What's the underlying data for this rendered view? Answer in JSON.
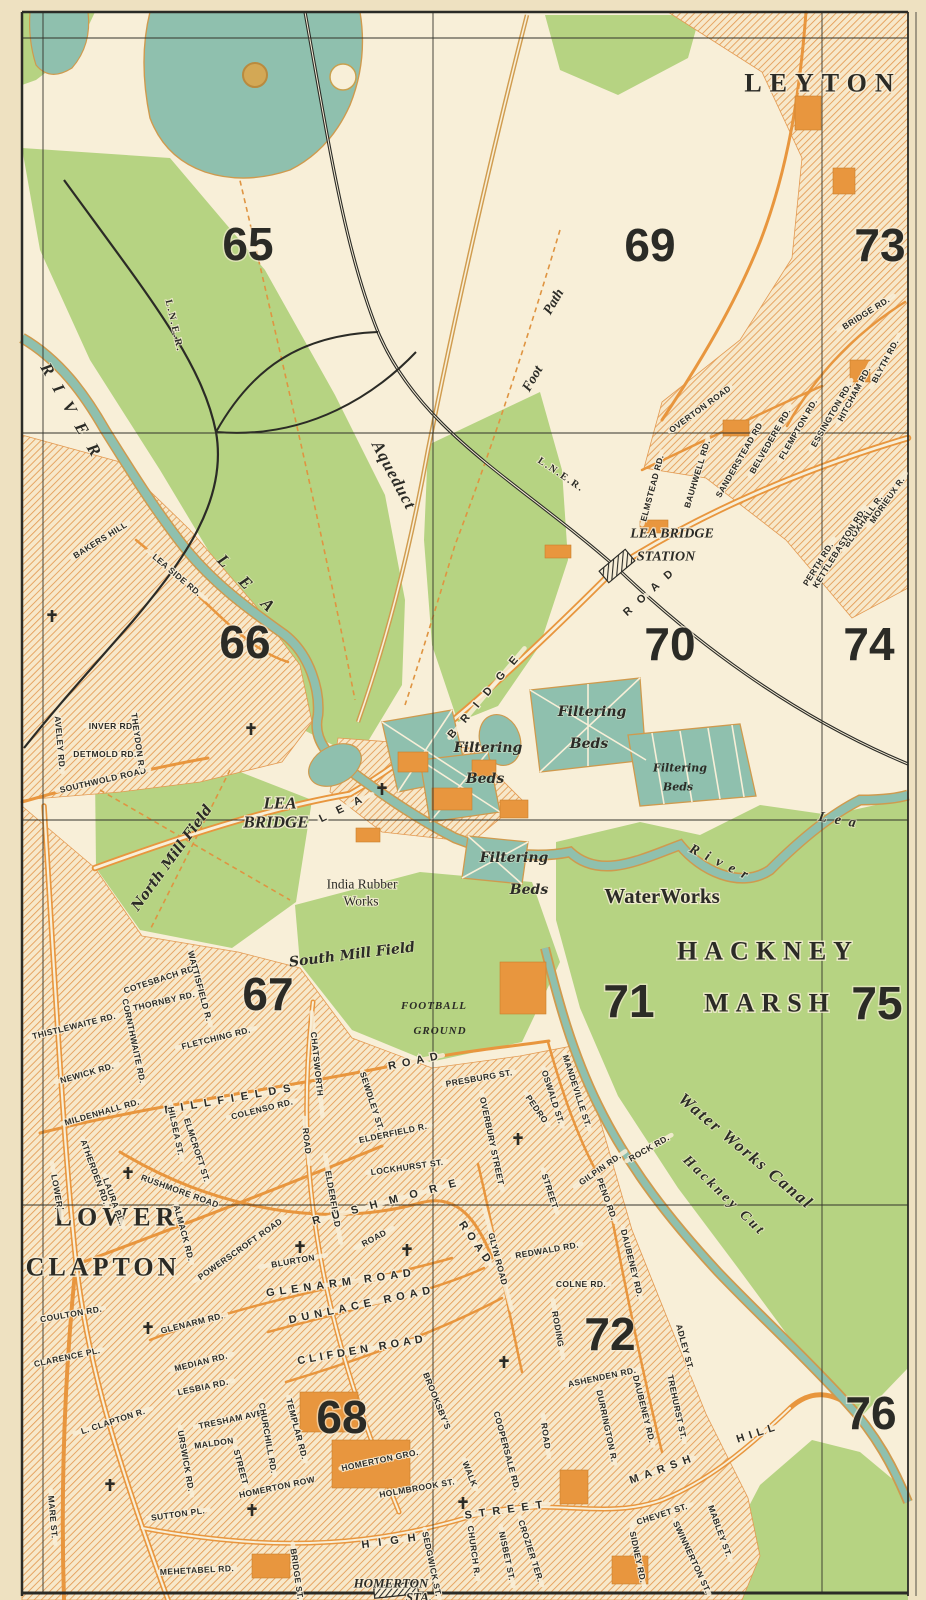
{
  "map": {
    "colors": {
      "paper": "#eee1c1",
      "map_bg": "#f8efd8",
      "green": "#b6d382",
      "water_teal": "#8fc0ae",
      "road_orange": "#e8963e",
      "ink": "#2b2b26"
    },
    "towns": [
      {
        "t": "LEYTON",
        "x": 823,
        "y": 83,
        "r": 0,
        "ls": 8,
        "fs": 26
      },
      {
        "t": "HACKNEY",
        "x": 768,
        "y": 951,
        "r": 0,
        "ls": 7,
        "fs": 27
      },
      {
        "t": "MARSH",
        "x": 770,
        "y": 1003,
        "r": 0,
        "ls": 7,
        "fs": 27
      },
      {
        "t": "LOWER",
        "x": 117,
        "y": 1217,
        "r": 0,
        "ls": 5,
        "fs": 25
      },
      {
        "t": "CLAPTON",
        "x": 103,
        "y": 1267,
        "r": 0,
        "ls": 4,
        "fs": 25
      }
    ],
    "grid_numbers": [
      {
        "t": "65",
        "x": 248,
        "y": 244
      },
      {
        "t": "69",
        "x": 650,
        "y": 245
      },
      {
        "t": "73",
        "x": 880,
        "y": 245
      },
      {
        "t": "66",
        "x": 245,
        "y": 642
      },
      {
        "t": "70",
        "x": 670,
        "y": 644
      },
      {
        "t": "74",
        "x": 869,
        "y": 644
      },
      {
        "t": "67",
        "x": 268,
        "y": 994
      },
      {
        "t": "71",
        "x": 629,
        "y": 1001
      },
      {
        "t": "75",
        "x": 877,
        "y": 1003
      },
      {
        "t": "68",
        "x": 342,
        "y": 1417
      },
      {
        "t": "72",
        "x": 610,
        "y": 1334
      },
      {
        "t": "76",
        "x": 871,
        "y": 1413
      }
    ],
    "places": [
      {
        "t": "LEA BRIDGE",
        "x": 672,
        "y": 534,
        "r": 0,
        "c": "place"
      },
      {
        "t": "STATION",
        "x": 666,
        "y": 557,
        "r": 0,
        "c": "place"
      },
      {
        "t": "LEA",
        "x": 280,
        "y": 803,
        "r": 0,
        "c": "place-lg"
      },
      {
        "t": "BRIDGE",
        "x": 276,
        "y": 822,
        "r": 0,
        "c": "place-lg"
      },
      {
        "t": "India Rubber",
        "x": 362,
        "y": 884,
        "r": 0,
        "c": "place-rm"
      },
      {
        "t": "Works",
        "x": 361,
        "y": 901,
        "r": 0,
        "c": "place-rm"
      },
      {
        "t": "WaterWorks",
        "x": 662,
        "y": 896,
        "r": 0,
        "c": "place-xl"
      },
      {
        "t": "HOMERTON",
        "x": 391,
        "y": 1583,
        "r": 0,
        "c": "place-it"
      },
      {
        "t": "STA.",
        "x": 419,
        "y": 1597,
        "r": 0,
        "c": "place-it"
      }
    ],
    "water_features": [
      {
        "t": "RIVER",
        "x": 74,
        "y": 415,
        "r": 60,
        "ls": 13,
        "c": "water-lg"
      },
      {
        "t": "LEA",
        "x": 253,
        "y": 590,
        "r": 45,
        "ls": 20,
        "c": "water-lg"
      },
      {
        "t": "River",
        "x": 722,
        "y": 864,
        "r": 26,
        "ls": 8
      },
      {
        "t": "Lea",
        "x": 841,
        "y": 821,
        "r": 10,
        "ls": 8
      },
      {
        "t": "Water Works Canal",
        "x": 746,
        "y": 1151,
        "r": 40,
        "ls": 2,
        "c": "water-lg"
      },
      {
        "t": "Hackney Cut",
        "x": 724,
        "y": 1196,
        "r": 44,
        "ls": 3
      },
      {
        "t": "Aqueduct",
        "x": 394,
        "y": 475,
        "r": 62,
        "ls": 1,
        "c": "water-lg"
      },
      {
        "t": "Foot",
        "x": 533,
        "y": 379,
        "r": -60
      },
      {
        "t": "Path",
        "x": 554,
        "y": 302,
        "r": -60
      }
    ],
    "railways": [
      {
        "t": "L.N.E.R.",
        "x": 174,
        "y": 326,
        "r": 77
      },
      {
        "t": "L.N.E.R.",
        "x": 561,
        "y": 475,
        "r": 34,
        "ls": 3
      }
    ],
    "fields": [
      {
        "t": "North Mill Field",
        "x": 172,
        "y": 858,
        "r": -54
      },
      {
        "t": "South Mill Field",
        "x": 352,
        "y": 955,
        "r": -7
      },
      {
        "t": "FOOTBALL",
        "x": 434,
        "y": 1006,
        "r": 0,
        "c": "field-caps"
      },
      {
        "t": "GROUND",
        "x": 440,
        "y": 1031,
        "r": 0,
        "c": "field-caps"
      },
      {
        "t": "Filtering",
        "x": 592,
        "y": 712,
        "r": 0
      },
      {
        "t": "Beds",
        "x": 589,
        "y": 744,
        "r": 0
      },
      {
        "t": "Filtering",
        "x": 488,
        "y": 748,
        "r": 0
      },
      {
        "t": "Beds",
        "x": 485,
        "y": 779,
        "r": 0
      },
      {
        "t": "Filtering",
        "x": 680,
        "y": 768,
        "r": 0,
        "c": "field-sm"
      },
      {
        "t": "Beds",
        "x": 678,
        "y": 787,
        "r": 0,
        "c": "field-sm"
      },
      {
        "t": "Filtering",
        "x": 514,
        "y": 858,
        "r": 0
      },
      {
        "t": "Beds",
        "x": 529,
        "y": 890,
        "r": 0
      }
    ],
    "streets": [
      {
        "t": "BRIDGE RD.",
        "x": 866,
        "y": 313,
        "r": -32
      },
      {
        "t": "BLYTH RD.",
        "x": 885,
        "y": 361,
        "r": -62
      },
      {
        "t": "HITCHAM RD.",
        "x": 854,
        "y": 394,
        "r": -62
      },
      {
        "t": "ESSINGTON RD.",
        "x": 831,
        "y": 415,
        "r": -60
      },
      {
        "t": "FLEMPTON RD.",
        "x": 798,
        "y": 429,
        "r": -60
      },
      {
        "t": "BELVEDERE RD.",
        "x": 770,
        "y": 441,
        "r": -60
      },
      {
        "t": "SANDERSTEAD RD",
        "x": 739,
        "y": 460,
        "r": -60
      },
      {
        "t": "OVERTON ROAD",
        "x": 700,
        "y": 409,
        "r": -36
      },
      {
        "t": "BAUHWELL RD.",
        "x": 697,
        "y": 474,
        "r": -73
      },
      {
        "t": "ELMSTEAD RD.",
        "x": 652,
        "y": 488,
        "r": -75
      },
      {
        "t": "MORIEUX R.",
        "x": 887,
        "y": 500,
        "r": -55
      },
      {
        "t": "BLOXHALL R.",
        "x": 863,
        "y": 521,
        "r": -55
      },
      {
        "t": "KETTLEBASTON RD.",
        "x": 839,
        "y": 548,
        "r": -58
      },
      {
        "t": "PERTH RD.",
        "x": 818,
        "y": 564,
        "r": -58
      },
      {
        "t": "LEA",
        "x": 346,
        "y": 807,
        "r": -26,
        "ls": 12,
        "fs": 12,
        "c": "street-lg"
      },
      {
        "t": "BRIDGE",
        "x": 487,
        "y": 693,
        "r": -50,
        "ls": 12,
        "fs": 12,
        "c": "street-lg"
      },
      {
        "t": "ROAD",
        "x": 652,
        "y": 590,
        "r": -42,
        "ls": 10,
        "fs": 12,
        "c": "street-lg"
      },
      {
        "t": "SOUTHWOLD ROAD",
        "x": 103,
        "y": 780,
        "r": -13,
        "fs": 9.5
      },
      {
        "t": "INVER RD.",
        "x": 112,
        "y": 726,
        "r": 0,
        "fs": 7.5
      },
      {
        "t": "DETMOLD RD.",
        "x": 105,
        "y": 754,
        "r": 0,
        "fs": 7.5
      },
      {
        "t": "THEYDON R.",
        "x": 138,
        "y": 741,
        "r": 82,
        "fs": 7.5
      },
      {
        "t": "AVELEY RD.",
        "x": 60,
        "y": 743,
        "r": 85,
        "fs": 7.5
      },
      {
        "t": "LEA SIDE RD.",
        "x": 177,
        "y": 575,
        "r": 40
      },
      {
        "t": "BAKERS HILL",
        "x": 100,
        "y": 540,
        "r": -32,
        "fs": 8
      },
      {
        "t": "THISTLEWAITE RD.",
        "x": 74,
        "y": 1026,
        "r": -14,
        "fs": 8
      },
      {
        "t": "NEWICK RD.",
        "x": 87,
        "y": 1073,
        "r": -16
      },
      {
        "t": "MILDENHALL RD.",
        "x": 102,
        "y": 1112,
        "r": -16,
        "fs": 8
      },
      {
        "t": "CORNTHWAITE RD.",
        "x": 134,
        "y": 1041,
        "r": 78,
        "fs": 8
      },
      {
        "t": "THORNBY RD.",
        "x": 164,
        "y": 1001,
        "r": -13,
        "fs": 8
      },
      {
        "t": "COTESBACH RD.",
        "x": 160,
        "y": 979,
        "r": -18,
        "fs": 8
      },
      {
        "t": "WATTISFIELD R.",
        "x": 200,
        "y": 986,
        "r": 75,
        "fs": 8
      },
      {
        "t": "FLETCHING RD.",
        "x": 216,
        "y": 1038,
        "r": -14
      },
      {
        "t": "MILLFIELDS",
        "x": 231,
        "y": 1099,
        "r": -10,
        "ls": 7,
        "fs": 10,
        "c": "street-lg"
      },
      {
        "t": "ROAD",
        "x": 416,
        "y": 1061,
        "r": -12,
        "ls": 6,
        "fs": 10,
        "c": "street-lg"
      },
      {
        "t": "HILSEA ST.",
        "x": 176,
        "y": 1131,
        "r": 78,
        "fs": 7.5
      },
      {
        "t": "ELMCROFT ST.",
        "x": 197,
        "y": 1150,
        "r": 72,
        "fs": 7.5
      },
      {
        "t": "COLENSO RD.",
        "x": 262,
        "y": 1109,
        "r": -14
      },
      {
        "t": "SEWDLEY ST.",
        "x": 372,
        "y": 1101,
        "r": 72,
        "fs": 7.5
      },
      {
        "t": "ELDERFIELD R.",
        "x": 393,
        "y": 1133,
        "r": -12,
        "fs": 8
      },
      {
        "t": "LOCKHURST ST.",
        "x": 407,
        "y": 1167,
        "r": -8
      },
      {
        "t": "CHATSWORTH",
        "x": 317,
        "y": 1064,
        "r": 84,
        "ls": 4,
        "fs": 9
      },
      {
        "t": "ROAD",
        "x": 307,
        "y": 1141,
        "r": 84,
        "ls": 4,
        "fs": 9
      },
      {
        "t": "ELDERFIELD",
        "x": 333,
        "y": 1199,
        "r": 80,
        "ls": 3,
        "fs": 8
      },
      {
        "t": "ATHERDEN RD.",
        "x": 95,
        "y": 1172,
        "r": 70,
        "fs": 8
      },
      {
        "t": "LAURA PL.",
        "x": 114,
        "y": 1201,
        "r": 70,
        "fs": 8
      },
      {
        "t": "LOWER",
        "x": 57,
        "y": 1191,
        "r": 80,
        "ls": 4,
        "fs": 9
      },
      {
        "t": "L. CLAPTON R.",
        "x": 113,
        "y": 1421,
        "r": -18
      },
      {
        "t": "MARE ST.",
        "x": 53,
        "y": 1517,
        "r": 85
      },
      {
        "t": "COULTON RD.",
        "x": 71,
        "y": 1314,
        "r": -10,
        "fs": 8
      },
      {
        "t": "CLARENCE PL.",
        "x": 67,
        "y": 1357,
        "r": -12,
        "fs": 8
      },
      {
        "t": "GLENARM RD.",
        "x": 192,
        "y": 1323,
        "r": -14
      },
      {
        "t": "MEDIAN RD.",
        "x": 201,
        "y": 1362,
        "r": -14
      },
      {
        "t": "LESBIA RD.",
        "x": 203,
        "y": 1387,
        "r": -12,
        "fs": 8
      },
      {
        "t": "TRESHAM AVE.",
        "x": 232,
        "y": 1419,
        "r": -12
      },
      {
        "t": "URSWICK RD.",
        "x": 186,
        "y": 1461,
        "r": 80
      },
      {
        "t": "MALDON",
        "x": 214,
        "y": 1443,
        "r": -8,
        "fs": 8
      },
      {
        "t": "STREET",
        "x": 241,
        "y": 1467,
        "r": 75,
        "fs": 8
      },
      {
        "t": "SUTTON PL.",
        "x": 178,
        "y": 1514,
        "r": -8,
        "fs": 8
      },
      {
        "t": "CHURCHILL RD.",
        "x": 268,
        "y": 1438,
        "r": 80,
        "fs": 8
      },
      {
        "t": "TEMPLAR RD.",
        "x": 297,
        "y": 1429,
        "r": 75,
        "fs": 8
      },
      {
        "t": "HOMERTON ROW",
        "x": 277,
        "y": 1487,
        "r": -12
      },
      {
        "t": "HOMERTON GRO.",
        "x": 380,
        "y": 1460,
        "r": -12
      },
      {
        "t": "HOLMBROOK ST.",
        "x": 417,
        "y": 1488,
        "r": -10,
        "fs": 8
      },
      {
        "t": "HIGH",
        "x": 393,
        "y": 1541,
        "r": -8,
        "ls": 9,
        "fs": 10,
        "c": "street-lg"
      },
      {
        "t": "STREET",
        "x": 507,
        "y": 1510,
        "r": -8,
        "ls": 7,
        "fs": 10,
        "c": "street-lg"
      },
      {
        "t": "MEHETABEL RD.",
        "x": 197,
        "y": 1570,
        "r": -3,
        "fs": 8
      },
      {
        "t": "BRIDGE ST.",
        "x": 297,
        "y": 1574,
        "r": 82,
        "fs": 8
      },
      {
        "t": "SEDGWICK ST.",
        "x": 432,
        "y": 1564,
        "r": 78,
        "fs": 8
      },
      {
        "t": "CHURCH R.",
        "x": 474,
        "y": 1551,
        "r": 82,
        "fs": 8
      },
      {
        "t": "NISBET ST.",
        "x": 507,
        "y": 1556,
        "r": 78,
        "fs": 8
      },
      {
        "t": "CROZIER TER.",
        "x": 531,
        "y": 1551,
        "r": 72,
        "fs": 8
      },
      {
        "t": "COOPERSALE RD.",
        "x": 507,
        "y": 1451,
        "r": 75,
        "fs": 8
      },
      {
        "t": "BROOKSBY'S",
        "x": 437,
        "y": 1401,
        "r": 68,
        "fs": 8
      },
      {
        "t": "WALK",
        "x": 470,
        "y": 1474,
        "r": 68,
        "fs": 8
      },
      {
        "t": "POWERSCROFT ROAD",
        "x": 240,
        "y": 1249,
        "r": -35,
        "ls": 1
      },
      {
        "t": "ALMACK RD.",
        "x": 184,
        "y": 1233,
        "r": 75,
        "fs": 8
      },
      {
        "t": "BLURTON",
        "x": 293,
        "y": 1261,
        "r": -10,
        "ls": 3
      },
      {
        "t": "ROAD",
        "x": 374,
        "y": 1238,
        "r": -28,
        "ls": 3
      },
      {
        "t": "GLENARM ROAD",
        "x": 341,
        "y": 1283,
        "r": -8,
        "ls": 5,
        "fs": 9.5,
        "c": "street-lg"
      },
      {
        "t": "DUNLACE ROAD",
        "x": 362,
        "y": 1305,
        "r": -12,
        "ls": 5,
        "fs": 9.5,
        "c": "street-lg"
      },
      {
        "t": "CLIFDEN ROAD",
        "x": 362,
        "y": 1350,
        "r": -10,
        "ls": 4,
        "fs": 9.5,
        "c": "street-lg"
      },
      {
        "t": "RUSHMORE ROAD",
        "x": 180,
        "y": 1191,
        "r": 20,
        "fs": 8
      },
      {
        "t": "RUSHMORE",
        "x": 390,
        "y": 1201,
        "r": -15,
        "ls": 12,
        "fs": 10,
        "c": "street-lg"
      },
      {
        "t": "ROAD",
        "x": 476,
        "y": 1244,
        "r": 55,
        "ls": 5,
        "fs": 10,
        "c": "street-lg"
      },
      {
        "t": "REDWALD RD.",
        "x": 547,
        "y": 1250,
        "r": -10
      },
      {
        "t": "GLYN ROAD",
        "x": 498,
        "y": 1259,
        "r": 75,
        "ls": 5,
        "fs": 9.5
      },
      {
        "t": "PEDRO",
        "x": 537,
        "y": 1109,
        "r": 55,
        "fs": 9
      },
      {
        "t": "STREET",
        "x": 550,
        "y": 1191,
        "r": 72,
        "fs": 9
      },
      {
        "t": "OVERBURY STREET",
        "x": 492,
        "y": 1141,
        "r": 78,
        "ls": 1,
        "fs": 8
      },
      {
        "t": "PRESBURG ST.",
        "x": 479,
        "y": 1078,
        "r": -10,
        "fs": 8
      },
      {
        "t": "OSWALD ST.",
        "x": 553,
        "y": 1097,
        "r": 72,
        "fs": 8
      },
      {
        "t": "MANDEVILLE ST.",
        "x": 577,
        "y": 1091,
        "r": 72,
        "fs": 8
      },
      {
        "t": "GILPIN RD.",
        "x": 600,
        "y": 1169,
        "r": -35,
        "fs": 8
      },
      {
        "t": "ROCK RD.",
        "x": 649,
        "y": 1148,
        "r": -30,
        "fs": 8
      },
      {
        "t": "PENO RD.",
        "x": 607,
        "y": 1199,
        "r": 70,
        "fs": 7.5
      },
      {
        "t": "COLNE RD.",
        "x": 581,
        "y": 1284,
        "r": 0,
        "fs": 8
      },
      {
        "t": "RODING",
        "x": 558,
        "y": 1329,
        "r": 80,
        "ls": 3
      },
      {
        "t": "ROAD",
        "x": 546,
        "y": 1436,
        "r": 82,
        "ls": 3
      },
      {
        "t": "DAUBENEY RD.",
        "x": 632,
        "y": 1263,
        "r": 76
      },
      {
        "t": "DAUBENEY RD.",
        "x": 644,
        "y": 1409,
        "r": 76
      },
      {
        "t": "ASHENDEN RD.",
        "x": 602,
        "y": 1377,
        "r": -12
      },
      {
        "t": "DURRINGTON R.",
        "x": 607,
        "y": 1426,
        "r": 78,
        "fs": 8
      },
      {
        "t": "TREHURST ST.",
        "x": 677,
        "y": 1407,
        "r": 78,
        "fs": 8
      },
      {
        "t": "ADLEY ST.",
        "x": 685,
        "y": 1347,
        "r": 75,
        "fs": 8
      },
      {
        "t": "MARSH",
        "x": 663,
        "y": 1469,
        "r": -20,
        "ls": 6,
        "fs": 9.5,
        "c": "street-lg"
      },
      {
        "t": "HILL",
        "x": 758,
        "y": 1433,
        "r": -18,
        "ls": 5,
        "fs": 9.5,
        "c": "street-lg"
      },
      {
        "t": "MABLEY ST.",
        "x": 720,
        "y": 1531,
        "r": 70,
        "fs": 8
      },
      {
        "t": "CHEVET ST.",
        "x": 662,
        "y": 1514,
        "r": -18,
        "fs": 8
      },
      {
        "t": "SIDNEY RD.",
        "x": 638,
        "y": 1557,
        "r": 78,
        "fs": 8
      },
      {
        "t": "SWINNERTON ST.",
        "x": 692,
        "y": 1557,
        "r": 65,
        "fs": 8
      }
    ],
    "church_crosses": [
      [
        52,
        616
      ],
      [
        251,
        729
      ],
      [
        382,
        789
      ],
      [
        518,
        1139
      ],
      [
        128,
        1173
      ],
      [
        148,
        1328
      ],
      [
        300,
        1247
      ],
      [
        407,
        1250
      ],
      [
        504,
        1362
      ],
      [
        110,
        1485
      ],
      [
        463,
        1503
      ],
      [
        252,
        1510
      ]
    ],
    "stations": [
      {
        "x": 617,
        "y": 566,
        "w": 34,
        "h": 15,
        "r": -40
      },
      {
        "x": 396,
        "y": 1590,
        "w": 44,
        "h": 12,
        "r": -6
      }
    ]
  }
}
